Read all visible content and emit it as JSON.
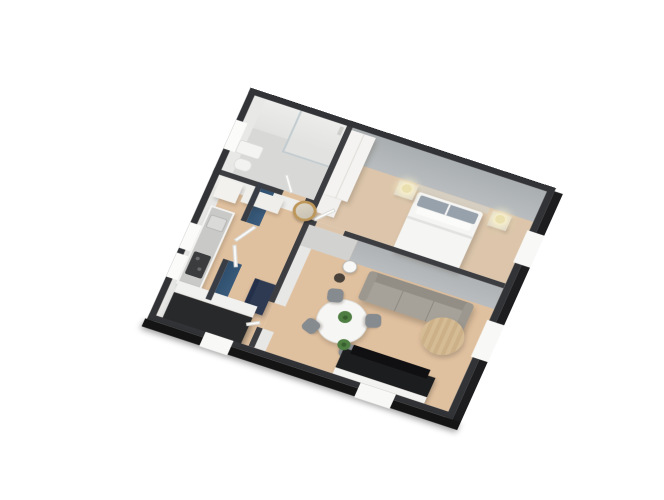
{
  "meta": {
    "view": "3d-floorplan-cutaway-render",
    "background": "#ffffff"
  },
  "camera": {
    "rotate_x_deg": 31,
    "rotate_z_deg": 21,
    "plan_left_px": 188,
    "plan_top_px": 109,
    "plan_width_units": 327,
    "plan_height_units": 289
  },
  "palette": {
    "exterior_wall_top": "#323336",
    "exterior_wall_face": "#17181a",
    "interior_wall_top": "#3c3d41",
    "blue_accent_wall": "#2e4d6c",
    "grey_bedroom_wall": "#b4b8ba",
    "white_wall": "#ececea",
    "wood_floor": "#e0c19f",
    "carpet_floor": "#dcc5aa",
    "bathroom_floor": "#d8d8d6",
    "sofa_grey": "#a6a29a",
    "console_black": "#1c1d1f",
    "mirror_gold": "#bd9659",
    "plant_green": "#4f7e43",
    "desk_navy": "#2d3a52"
  },
  "rooms": [
    {
      "name": "bathroom",
      "features": [
        "glass-shower",
        "window",
        "sink",
        "toilet"
      ]
    },
    {
      "name": "hallway",
      "features": [
        "blue-accent-wall",
        "round-gold-mirror",
        "white-cabinets",
        "navy-desk",
        "entry-doors"
      ]
    },
    {
      "name": "kitchen",
      "features": [
        "counter-with-cooktop",
        "sink",
        "black-island",
        "two-windows"
      ]
    },
    {
      "name": "bedroom",
      "features": [
        "double-bed",
        "two-nightstands",
        "two-lamps",
        "wardrobe",
        "window"
      ]
    },
    {
      "name": "living-room",
      "features": [
        "grey-sofa",
        "round-dining-table",
        "four-chairs",
        "round-coffee-table",
        "tv-console",
        "plants",
        "windows"
      ]
    }
  ],
  "scene": {
    "items": [
      {
        "n": "floor-bathroom",
        "x": 7,
        "y": 7,
        "w": 99,
        "h": 95,
        "c": "#d8d8d6"
      },
      {
        "n": "floor-shower",
        "x": 58,
        "y": 7,
        "w": 48,
        "h": 52,
        "c": "#e2e2e0"
      },
      {
        "n": "floor-hall-kitchen",
        "x": 7,
        "y": 106,
        "w": 99,
        "h": 176,
        "c": "#e0c19f",
        "cls": "wood"
      },
      {
        "n": "floor-living",
        "x": 112,
        "y": 128,
        "w": 208,
        "h": 154,
        "c": "#e0c19f",
        "cls": "wood"
      },
      {
        "n": "floor-bedroom",
        "x": 112,
        "y": 7,
        "w": 208,
        "h": 115,
        "c": "#dcc5aa"
      },
      {
        "n": "floor-door-gap-bathroom",
        "x": 74,
        "y": 100,
        "w": 24,
        "h": 6,
        "c": "#e0c19f"
      },
      {
        "n": "floor-door-gap-bedroom",
        "x": 118,
        "y": 122,
        "w": 30,
        "h": 6,
        "c": "#dcc5aa"
      },
      {
        "n": "floor-door-gap-living",
        "x": 106,
        "y": 226,
        "w": 6,
        "h": 32,
        "c": "#e0c19f"
      },
      {
        "n": "floor-door-gap-entry",
        "x": 46,
        "y": 148,
        "w": 6,
        "h": 48,
        "c": "#e0c19f"
      },
      {
        "n": "wallface-bathroom-ne",
        "x": 7,
        "y": 7,
        "w": 99,
        "h": 36,
        "bg": "linear-gradient(#ececea,#e2e2e0)"
      },
      {
        "n": "wallface-bedroom-ne",
        "x": 112,
        "y": 7,
        "w": 208,
        "h": 38,
        "bg": "radial-gradient(closest-side at 30% 105%, rgba(255,255,248,0.95), rgba(255,255,248,0) 75%), radial-gradient(closest-side at 78% 105%, rgba(255,255,248,0.95), rgba(255,255,248,0) 75%), linear-gradient(#a9aeb0,#b9bdbf)"
      },
      {
        "n": "wallface-bathroom-nw",
        "x": 7,
        "y": 7,
        "w": 12,
        "h": 93,
        "c": "#e8e8e6"
      },
      {
        "n": "wallface-kitchen-nw",
        "x": 7,
        "y": 106,
        "w": 10,
        "h": 176,
        "c": "#e6e6e4"
      },
      {
        "n": "wallface-hall-n",
        "x": 7,
        "y": 106,
        "w": 99,
        "h": 14,
        "c": "#ededeb"
      },
      {
        "n": "wallface-living-n-left",
        "x": 112,
        "y": 128,
        "w": 52,
        "h": 26,
        "c": "#d2d2d0"
      },
      {
        "n": "wallface-living-n-right",
        "x": 164,
        "y": 128,
        "w": 156,
        "h": 26,
        "bg": "radial-gradient(closest-side at 50% 110%, rgba(248,248,244,0.5), rgba(248,248,244,0) 80%), linear-gradient(#aeb2b4,#b9bdbf)"
      },
      {
        "n": "wallface-living-w-upper",
        "x": 112,
        "y": 154,
        "w": 12,
        "h": 72,
        "c": "#e7e7e5"
      },
      {
        "n": "wallface-living-w-lower",
        "x": 112,
        "y": 258,
        "w": 12,
        "h": 24,
        "c": "#e7e7e5"
      },
      {
        "n": "wallface-blue-upper",
        "x": 52,
        "y": 100,
        "w": 14,
        "h": 48,
        "bg": "linear-gradient(100deg,#2e4d6c,#3c5d7e)"
      },
      {
        "n": "wallface-blue-lower",
        "x": 52,
        "y": 196,
        "w": 14,
        "h": 50,
        "bg": "linear-gradient(100deg,#2e4d6c,#3c5d7e)"
      },
      {
        "n": "shower-glass-panel",
        "x": 56,
        "y": 7,
        "w": 2,
        "h": 52,
        "c": "#c2ccd0"
      },
      {
        "n": "shower-glass-return",
        "x": 56,
        "y": 57,
        "w": 50,
        "h": 2,
        "c": "#c2ccd0"
      },
      {
        "n": "shower-column",
        "x": 100,
        "y": 10,
        "w": 4,
        "h": 10,
        "c": "#cfcfcd"
      },
      {
        "n": "bathroom-sink",
        "x": 12,
        "y": 60,
        "w": 26,
        "h": 16,
        "c": "#f4f4f2",
        "r": 3,
        "b": "1px solid #dcdcda"
      },
      {
        "n": "bathroom-toilet",
        "x": 16,
        "y": 80,
        "w": 18,
        "h": 14,
        "c": "#f2f2f0",
        "r": 6,
        "b": "1px solid #dededc"
      },
      {
        "n": "hall-cabinet-tall",
        "x": 10,
        "y": 108,
        "w": 24,
        "h": 24,
        "c": "#f2f1ed",
        "sh": "2px 3px 4px rgba(60,50,40,0.22)"
      },
      {
        "n": "hall-cabinet-low",
        "x": 38,
        "y": 110,
        "w": 40,
        "h": 18,
        "c": "#efeeea",
        "sh": "2px 3px 4px rgba(60,50,40,0.20)"
      },
      {
        "n": "hall-desk-navy",
        "x": 84,
        "y": 206,
        "w": 22,
        "h": 38,
        "c": "#2d3a52",
        "sh": "2px 3px 5px rgba(40,40,50,0.35)",
        "children": [
          {
            "n": "desk-edge",
            "x": 0,
            "y": 0,
            "w": 5,
            "h": 38,
            "c": "#24304a"
          }
        ]
      },
      {
        "n": "kitchen-counter",
        "x": 12,
        "y": 142,
        "w": 26,
        "h": 98,
        "c": "#f3f3f1",
        "sh": "2px 2px 4px rgba(60,50,40,0.20)"
      },
      {
        "n": "kitchen-countertop",
        "x": 14,
        "y": 144,
        "w": 22,
        "h": 94,
        "c": "#c9c9c7"
      },
      {
        "n": "kitchen-sink",
        "x": 16,
        "y": 152,
        "w": 18,
        "h": 16,
        "c": "#dadad8",
        "r": 2,
        "b": "1px solid #b5b5b3"
      },
      {
        "n": "kitchen-cooktop",
        "x": 16,
        "y": 198,
        "w": 18,
        "h": 28,
        "c": "#3b3c3e",
        "r": 2,
        "children": [
          {
            "n": "burner-1",
            "x": 4,
            "y": 5,
            "w": 4,
            "h": 4,
            "c": "#6a6b6d",
            "circle": true
          },
          {
            "n": "burner-2",
            "x": 10,
            "y": 16,
            "w": 4,
            "h": 4,
            "c": "#6a6b6d",
            "circle": true
          }
        ]
      },
      {
        "n": "kitchen-island-top",
        "x": 14,
        "y": 236,
        "w": 84,
        "h": 14,
        "c": "#f1f1ef",
        "sh": "2px 2px 4px rgba(60,50,40,0.22)"
      },
      {
        "n": "kitchen-island-black",
        "x": 14,
        "y": 250,
        "w": 84,
        "h": 34,
        "c": "#28292b",
        "sh": "3px 4px 6px rgba(30,30,30,0.4)"
      },
      {
        "n": "bedroom-wardrobe",
        "x": 112,
        "y": 10,
        "w": 26,
        "h": 80,
        "c": "#f4f3f1",
        "sh": "3px 3px 5px rgba(80,70,60,0.25)",
        "children": [
          {
            "n": "wardrobe-seam",
            "x": 13,
            "y": 0,
            "w": 1,
            "h": 80,
            "c": "#dddcd8"
          }
        ]
      },
      {
        "n": "bedroom-chest",
        "x": 112,
        "y": 90,
        "w": 20,
        "h": 22,
        "c": "#f1f0ee",
        "sh": "2px 2px 4px rgba(80,70,60,0.2)"
      },
      {
        "n": "bed-headboard",
        "x": 196,
        "y": 45,
        "w": 78,
        "h": 8,
        "c": "#d6cec0",
        "r": 2
      },
      {
        "n": "bed",
        "x": 200,
        "y": 53,
        "w": 70,
        "h": 74,
        "c": "#f5f5f3",
        "r": 3,
        "sh": "3px 3px 5px rgba(90,80,70,0.25)",
        "children": [
          {
            "n": "bed-pillows",
            "x": 4,
            "y": 3,
            "w": 62,
            "h": 13,
            "c": "#97a1ac",
            "r": 2
          },
          {
            "n": "bed-pillow-gap",
            "x": 34,
            "y": 3,
            "w": 2,
            "h": 13,
            "c": "#f5f5f3"
          },
          {
            "n": "bed-pillows-white",
            "x": 6,
            "y": 17,
            "w": 58,
            "h": 8,
            "c": "#fbfbfa",
            "r": 2
          },
          {
            "n": "bed-duvet-fold",
            "x": 0,
            "y": 30,
            "w": 70,
            "h": 3,
            "c": "#e2e2e0"
          }
        ]
      },
      {
        "n": "nightstand-left",
        "x": 178,
        "y": 47,
        "w": 20,
        "h": 18,
        "c": "#ddd6c8",
        "sh": "2px 2px 3px rgba(90,80,70,0.25)"
      },
      {
        "n": "nightstand-right",
        "x": 278,
        "y": 47,
        "w": 20,
        "h": 18,
        "c": "#ddd6c8",
        "sh": "2px 2px 3px rgba(90,80,70,0.25)"
      },
      {
        "n": "lamp-left",
        "x": 183,
        "y": 49,
        "w": 10,
        "h": 10,
        "circle": true,
        "c": "#eadfae",
        "sh": "0 0 9px 5px rgba(255,246,205,0.9)"
      },
      {
        "n": "lamp-right",
        "x": 283,
        "y": 49,
        "w": 10,
        "h": 10,
        "circle": true,
        "c": "#eadfae",
        "sh": "0 0 9px 5px rgba(255,246,205,0.9)"
      },
      {
        "n": "side-table",
        "x": 160,
        "y": 152,
        "w": 15,
        "h": 15,
        "circle": true,
        "c": "#f7f7f5",
        "b": "1px solid #b9b9b7",
        "sh": "1px 2px 3px rgba(80,70,60,0.25)"
      },
      {
        "n": "side-stool",
        "x": 157,
        "y": 170,
        "w": 11,
        "h": 11,
        "circle": true,
        "c": "#49423b"
      },
      {
        "n": "sofa",
        "x": 188,
        "y": 156,
        "w": 112,
        "h": 36,
        "c": "#a6a29a",
        "r": 5,
        "sh": "3px 4px 6px rgba(80,70,60,0.3)",
        "children": [
          {
            "n": "sofa-back",
            "x": 0,
            "y": 0,
            "w": 112,
            "h": 11,
            "c": "#928e86",
            "r": 5
          },
          {
            "n": "sofa-arm-left",
            "x": 0,
            "y": 0,
            "w": 9,
            "h": 36,
            "c": "#9c9890",
            "r": 4
          },
          {
            "n": "sofa-arm-right",
            "x": 103,
            "y": 0,
            "w": 9,
            "h": 36,
            "c": "#9c9890",
            "r": 4
          },
          {
            "n": "sofa-seam-1",
            "x": 39,
            "y": 11,
            "w": 1,
            "h": 25,
            "c": "#8e8a82"
          },
          {
            "n": "sofa-seam-2",
            "x": 72,
            "y": 11,
            "w": 1,
            "h": 25,
            "c": "#8e8a82"
          }
        ]
      },
      {
        "n": "coffee-table",
        "x": 261,
        "y": 180,
        "w": 44,
        "h": 44,
        "circle": true,
        "bg": "repeating-linear-gradient(90deg,#d6bc95 0 4px,#cbb088 4px 8px)",
        "sh": "2px 3px 5px rgba(90,80,70,0.3)"
      },
      {
        "n": "dining-table",
        "x": 157,
        "y": 196,
        "w": 52,
        "h": 52,
        "circle": true,
        "c": "#f6f6f4",
        "b": "1px solid #e0e0de",
        "sh": "2px 3px 5px rgba(90,80,70,0.28)",
        "children": [
          {
            "n": "dining-plant",
            "x": 19,
            "y": 12,
            "w": 14,
            "h": 14,
            "circle": true,
            "c": "#4f7e43"
          },
          {
            "n": "dining-plant-core",
            "x": 24,
            "y": 17,
            "w": 5,
            "h": 5,
            "circle": true,
            "c": "#38602f"
          }
        ]
      },
      {
        "n": "dining-chair-1",
        "x": 158,
        "y": 188,
        "w": 16,
        "h": 16,
        "r": 5,
        "c": "#868b90",
        "rot": -15,
        "sh": "1px 2px 3px rgba(80,70,60,0.3)"
      },
      {
        "n": "dining-chair-2",
        "x": 204,
        "y": 202,
        "w": 16,
        "h": 16,
        "r": 5,
        "c": "#868b90",
        "rot": 70,
        "sh": "1px 2px 3px rgba(80,70,60,0.3)"
      },
      {
        "n": "dining-chair-3",
        "x": 148,
        "y": 230,
        "w": 16,
        "h": 16,
        "r": 5,
        "c": "#868b90",
        "rot": -70,
        "sh": "1px 2px 3px rgba(80,70,60,0.3)"
      },
      {
        "n": "dining-chair-4",
        "x": 192,
        "y": 244,
        "w": 16,
        "h": 16,
        "r": 5,
        "c": "#868b90",
        "rot": 170,
        "sh": "1px 2px 3px rgba(80,70,60,0.3)"
      },
      {
        "n": "tv-console",
        "x": 196,
        "y": 250,
        "w": 98,
        "h": 32,
        "sh": "2px 3px 5px rgba(40,40,40,0.35)",
        "children": [
          {
            "n": "tv-console-plinth",
            "x": 0,
            "y": 24,
            "w": 98,
            "h": 8,
            "c": "#f2f2f0"
          },
          {
            "n": "tv-console-body",
            "x": 0,
            "y": 0,
            "w": 98,
            "h": 24,
            "c": "#1c1d1f"
          },
          {
            "n": "tv-screen",
            "x": 8,
            "y": -7,
            "w": 82,
            "h": 11,
            "c": "#101012"
          }
        ]
      },
      {
        "n": "tv-plant",
        "x": 188,
        "y": 240,
        "w": 13,
        "h": 13,
        "circle": true,
        "c": "#4f7e43",
        "children": [
          {
            "n": "tv-plant-core",
            "x": 4,
            "y": 4,
            "w": 5,
            "h": 5,
            "circle": true,
            "c": "#38602f"
          }
        ]
      },
      {
        "n": "wall-bathroom-s-a",
        "x": 0,
        "y": 100,
        "w": 74,
        "h": 6,
        "c": "#3c3d41"
      },
      {
        "n": "wall-bathroom-s-b",
        "x": 98,
        "y": 100,
        "w": 14,
        "h": 6,
        "c": "#3c3d41"
      },
      {
        "n": "wall-bedroom-w",
        "x": 106,
        "y": 0,
        "w": 6,
        "h": 128,
        "c": "#3c3d41"
      },
      {
        "n": "wall-bedroom-s-a",
        "x": 106,
        "y": 122,
        "w": 12,
        "h": 6,
        "c": "#3c3d41"
      },
      {
        "n": "wall-bedroom-s-b",
        "x": 148,
        "y": 122,
        "w": 172,
        "h": 6,
        "c": "#3c3d41"
      },
      {
        "n": "wall-hall-e-upper",
        "x": 106,
        "y": 128,
        "w": 6,
        "h": 98,
        "c": "#3c3d41"
      },
      {
        "n": "wall-hall-e-lower",
        "x": 106,
        "y": 258,
        "w": 6,
        "h": 24,
        "c": "#3c3d41"
      },
      {
        "n": "wall-blue-upper",
        "x": 46,
        "y": 100,
        "w": 6,
        "h": 48,
        "c": "#383c44"
      },
      {
        "n": "wall-blue-lower",
        "x": 46,
        "y": 196,
        "w": 6,
        "h": 50,
        "c": "#383c44"
      },
      {
        "n": "wall-exterior-ne",
        "x": 0,
        "y": 0,
        "w": 327,
        "h": 7,
        "c": "#323336"
      },
      {
        "n": "wall-exterior-nw",
        "x": 0,
        "y": 0,
        "w": 7,
        "h": 289,
        "c": "#323336"
      },
      {
        "n": "wall-exterior-sw",
        "x": 0,
        "y": 282,
        "w": 327,
        "h": 7,
        "c": "#323336"
      },
      {
        "n": "wall-exterior-se",
        "x": 320,
        "y": 0,
        "w": 7,
        "h": 289,
        "c": "#323336"
      },
      {
        "n": "wall-outer-face-se",
        "x": 327,
        "y": 4,
        "w": 9,
        "h": 290,
        "c": "#1d1d1f"
      },
      {
        "n": "wall-outer-face-sw",
        "x": -2,
        "y": 289,
        "w": 338,
        "h": 10,
        "c": "#141415",
        "sh": "0 3px 7px rgba(0,0,0,0.38)"
      },
      {
        "n": "window-bathroom-nw",
        "x": 0,
        "y": 40,
        "w": 12,
        "h": 36,
        "c": "#fbfbf9"
      },
      {
        "n": "window-kitchen-nw-1",
        "x": 0,
        "y": 168,
        "w": 12,
        "h": 32,
        "c": "#fbfbf9"
      },
      {
        "n": "window-kitchen-nw-2",
        "x": 0,
        "y": 206,
        "w": 12,
        "h": 30,
        "c": "#fbfbf9"
      },
      {
        "n": "window-bedroom-se",
        "x": 318,
        "y": 56,
        "w": 18,
        "h": 40,
        "c": "#f8f8f6"
      },
      {
        "n": "window-living-se",
        "x": 318,
        "y": 168,
        "w": 18,
        "h": 46,
        "c": "#f8f8f6"
      },
      {
        "n": "window-living-sw",
        "x": 226,
        "y": 282,
        "w": 38,
        "h": 18,
        "c": "#f8f8f6"
      },
      {
        "n": "window-entry-sw",
        "x": 60,
        "y": 282,
        "w": 30,
        "h": 18,
        "c": "#f8f8f6"
      },
      {
        "n": "door-leaf-entry-1",
        "x": 54,
        "y": 148,
        "w": 4,
        "h": 26,
        "c": "#fbfbf9",
        "b": "1px solid #d8d8d6",
        "rot": 30
      },
      {
        "n": "door-leaf-entry-2",
        "x": 54,
        "y": 176,
        "w": 4,
        "h": 26,
        "c": "#fbfbf9",
        "b": "1px solid #d8d8d6",
        "rot": -24
      },
      {
        "n": "door-leaf-bathroom",
        "x": 74,
        "y": 80,
        "w": 4,
        "h": 22,
        "c": "#fbfbf9",
        "b": "1px solid #d8d8d6",
        "rot": -35
      },
      {
        "n": "door-leaf-bedroom",
        "x": 120,
        "y": 100,
        "w": 4,
        "h": 24,
        "c": "#fbfbf9",
        "b": "1px solid #d8d8d6",
        "rot": 40
      },
      {
        "n": "door-leaf-living",
        "x": 94,
        "y": 254,
        "w": 14,
        "h": 4,
        "c": "#fbfbf9",
        "b": "1px solid #d8d8d6",
        "rot": -30
      },
      {
        "n": "wall-mirror",
        "x": 90,
        "y": 103,
        "w": 24,
        "h": 24,
        "circle": true,
        "bg": "linear-gradient(135deg,#ddd6c8,#c6bfae)",
        "b": "3px solid #bd9659",
        "sh": "1px 2px 3px rgba(0,0,0,0.25)"
      }
    ]
  }
}
